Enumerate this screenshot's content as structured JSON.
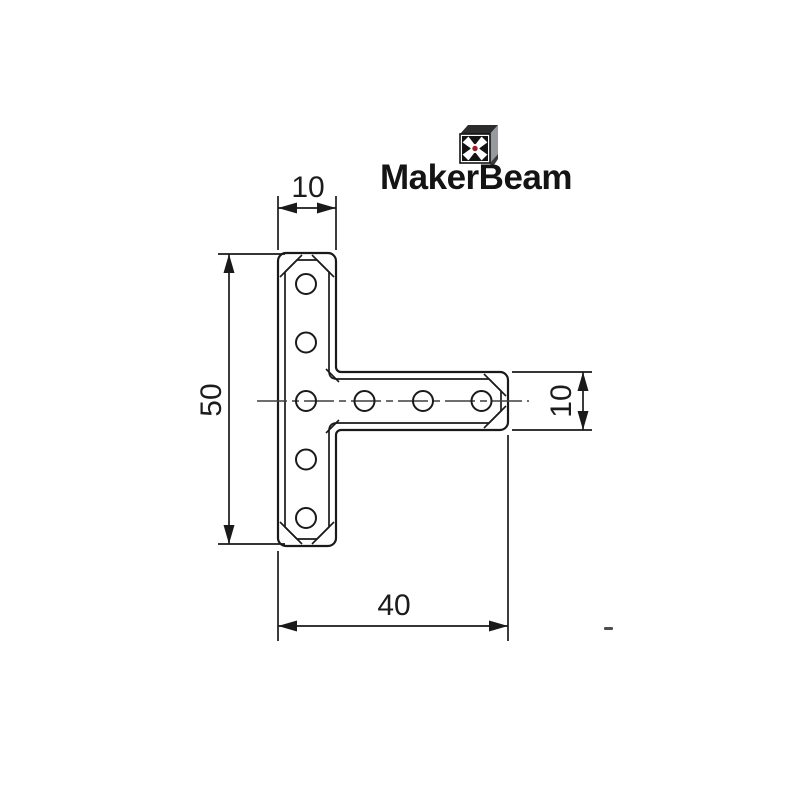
{
  "page": {
    "width": 800,
    "height": 800,
    "background": "#ffffff"
  },
  "logo": {
    "text": "MakerBeam",
    "icon": "makerbeam-profile-cube",
    "text_color": "#141414",
    "icon_colors": {
      "face": "#ffffff",
      "slots": "#131313",
      "center_dot": "#a21d21",
      "side_3d": "#96999e",
      "top_3d": "#2c2c2c"
    }
  },
  "drawing": {
    "kind": "technical-dimension-drawing",
    "part": "T-shaped flat bracket with 8 bolt holes",
    "units": "mm",
    "line_color": "#1a1a1a",
    "centerline_color": "#3f3f3f",
    "holes": {
      "count": 8,
      "vertical_column": 5,
      "horizontal_row": 4,
      "shared_center": 1
    },
    "dimensions": {
      "top_width": "10",
      "left_height": "50",
      "right_thickness": "10",
      "bottom_length": "40"
    }
  }
}
